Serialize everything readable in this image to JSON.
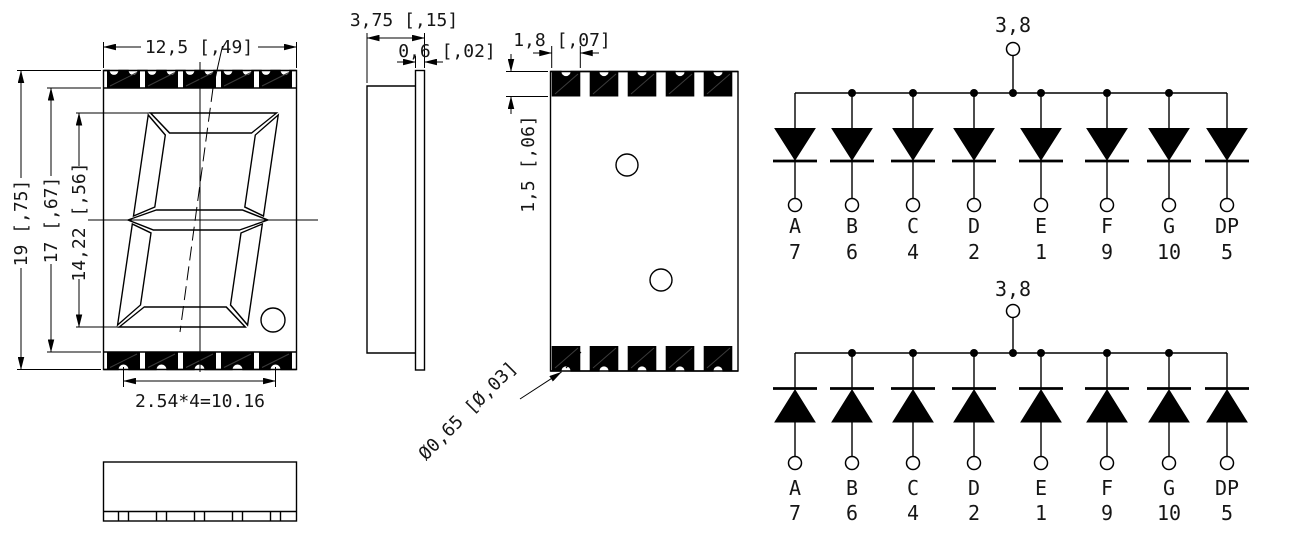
{
  "front_view": {
    "dim_width": "12,5 [,49]",
    "dim_height_overall": "19 [,75]",
    "dim_height_inner": "17 [,67]",
    "dim_height_digit": "14,22 [,56]",
    "dim_pad_pitch": "2.54*4=10.16"
  },
  "side_view": {
    "dim_depth": "3,75 [,15]",
    "dim_substrate": "0,6 [,02]"
  },
  "back_view": {
    "dim_pad_width": "1,8 [,07]",
    "dim_pad_height": "1,5 [,06]",
    "dim_notch_dia": "Ø0,65 [Ø,03]"
  },
  "circuits": [
    {
      "common_pin": "3,8",
      "pins": [
        {
          "letter": "A",
          "number": "7"
        },
        {
          "letter": "B",
          "number": "6"
        },
        {
          "letter": "C",
          "number": "4"
        },
        {
          "letter": "D",
          "number": "2"
        },
        {
          "letter": "E",
          "number": "1"
        },
        {
          "letter": "F",
          "number": "9"
        },
        {
          "letter": "G",
          "number": "10"
        },
        {
          "letter": "DP",
          "number": "5"
        }
      ]
    },
    {
      "common_pin": "3,8",
      "pins": [
        {
          "letter": "A",
          "number": "7"
        },
        {
          "letter": "B",
          "number": "6"
        },
        {
          "letter": "C",
          "number": "4"
        },
        {
          "letter": "D",
          "number": "2"
        },
        {
          "letter": "E",
          "number": "1"
        },
        {
          "letter": "F",
          "number": "9"
        },
        {
          "letter": "G",
          "number": "10"
        },
        {
          "letter": "DP",
          "number": "5"
        }
      ]
    }
  ]
}
